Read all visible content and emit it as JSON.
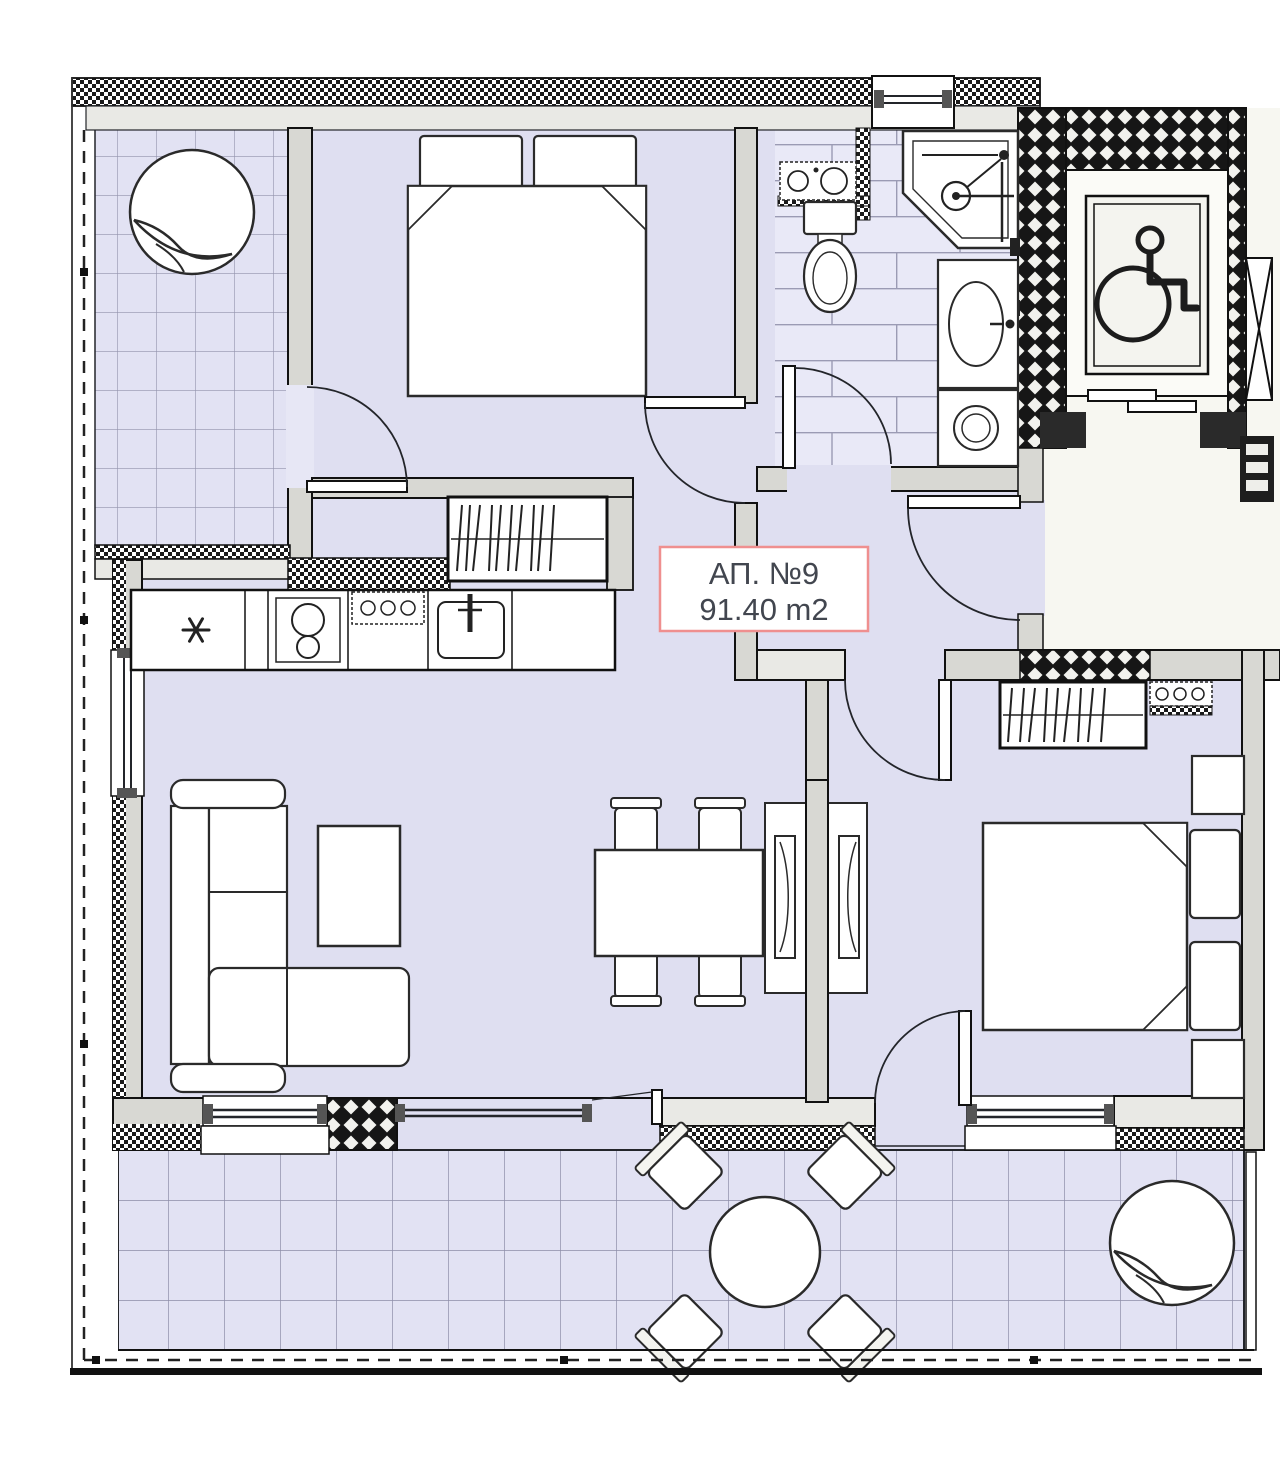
{
  "apartment": {
    "label": "АП. №9",
    "area": "91.40 m2"
  },
  "colors": {
    "room_fill": "#dfdff1",
    "tile_fill": "#e2e2f3",
    "brick_fill": "#e9e9f7",
    "common_area_fill": "#f7f7f1",
    "wall_dark": "#161616",
    "wall_gray": "#d8d8d3",
    "wall_face": "#e9e9e5",
    "line": "#23252a",
    "label_border": "#ef8f8f",
    "label_text": "#42464f"
  },
  "icons": {
    "wheelchair-icon": "accessible elevator symbol",
    "plant-icon": "shrub / plant on terrace",
    "freezer-star-icon": "fridge star symbol",
    "shower-icon": "corner shower with shower head",
    "x-brace-icon": "shaft cross bracing",
    "hanger-icon": "wardrobe hanging rail strokes"
  }
}
